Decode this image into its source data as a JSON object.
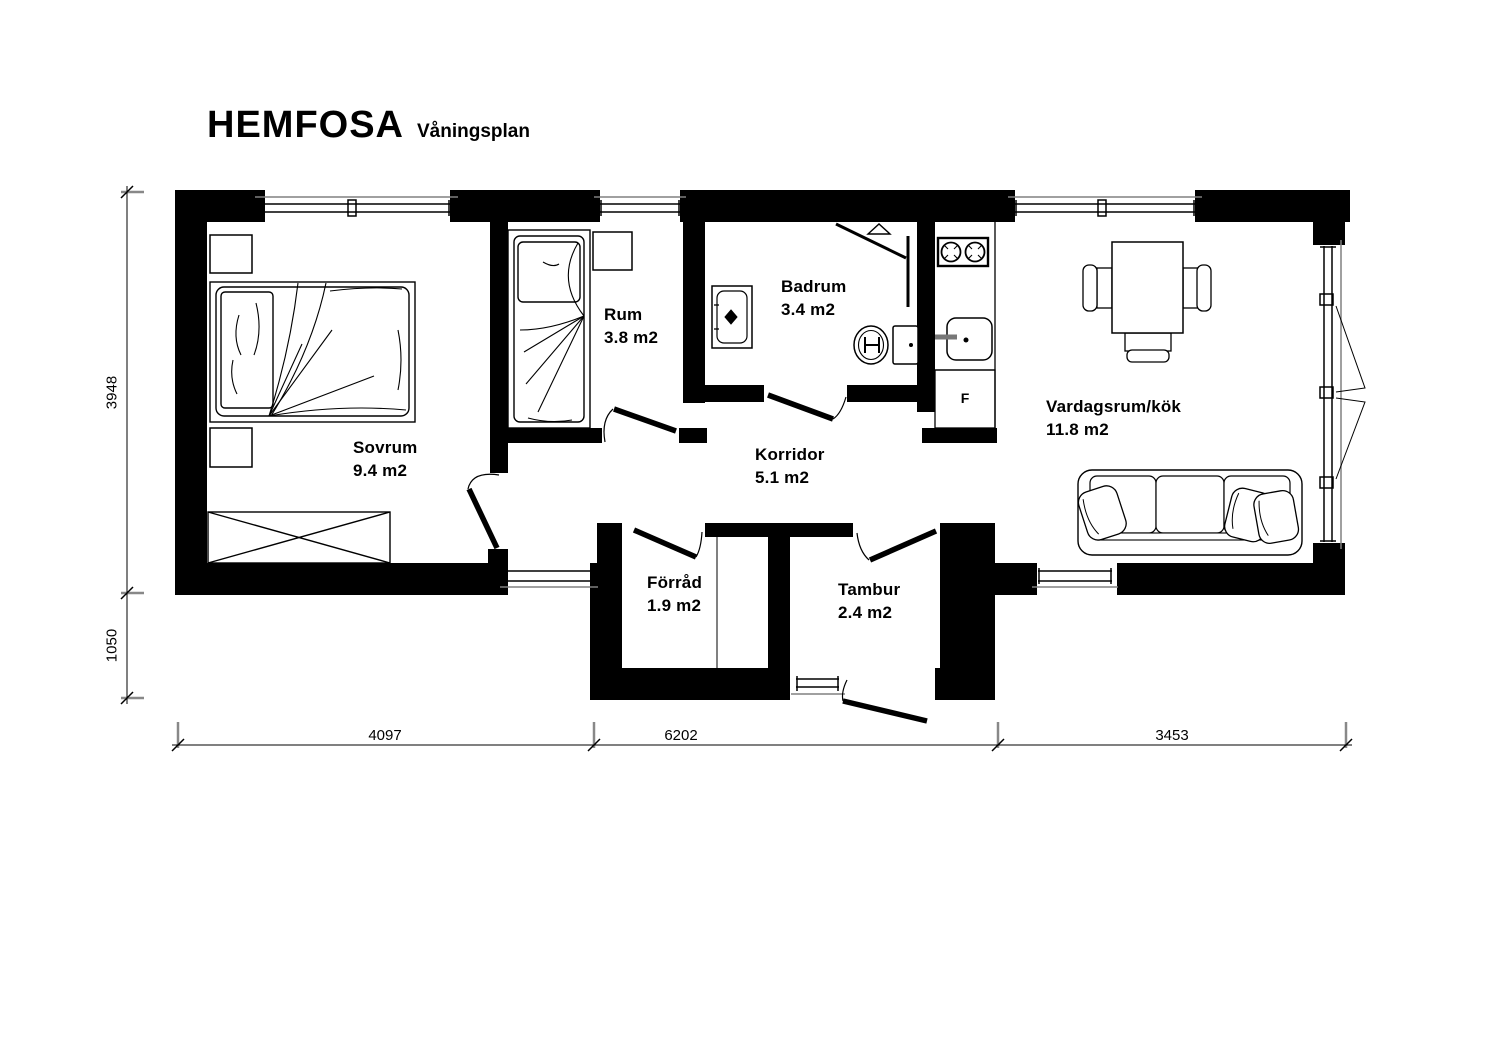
{
  "title": {
    "name": "HEMFOSA",
    "subtitle": "Våningsplan"
  },
  "rooms": [
    {
      "id": "sovrum",
      "name": "Sovrum",
      "area": "9.4 m2"
    },
    {
      "id": "rum",
      "name": "Rum",
      "area": "3.8 m2"
    },
    {
      "id": "badrum",
      "name": "Badrum",
      "area": "3.4 m2"
    },
    {
      "id": "korridor",
      "name": "Korridor",
      "area": "5.1 m2"
    },
    {
      "id": "vardagsrum",
      "name": "Vardagsrum/kök",
      "area": "11.8 m2"
    },
    {
      "id": "forrad",
      "name": "Förråd",
      "area": "1.9 m2"
    },
    {
      "id": "tambur",
      "name": "Tambur",
      "area": "2.4 m2"
    }
  ],
  "appliances": {
    "fridge_label": "F"
  },
  "dimensions": {
    "vertical_upper": "3948",
    "vertical_lower": "1050",
    "horizontal_left": "4097",
    "horizontal_middle": "6202",
    "horizontal_right": "3453"
  },
  "colors": {
    "wall": "#000000",
    "background": "#ffffff",
    "sill_gray": "#808080"
  }
}
